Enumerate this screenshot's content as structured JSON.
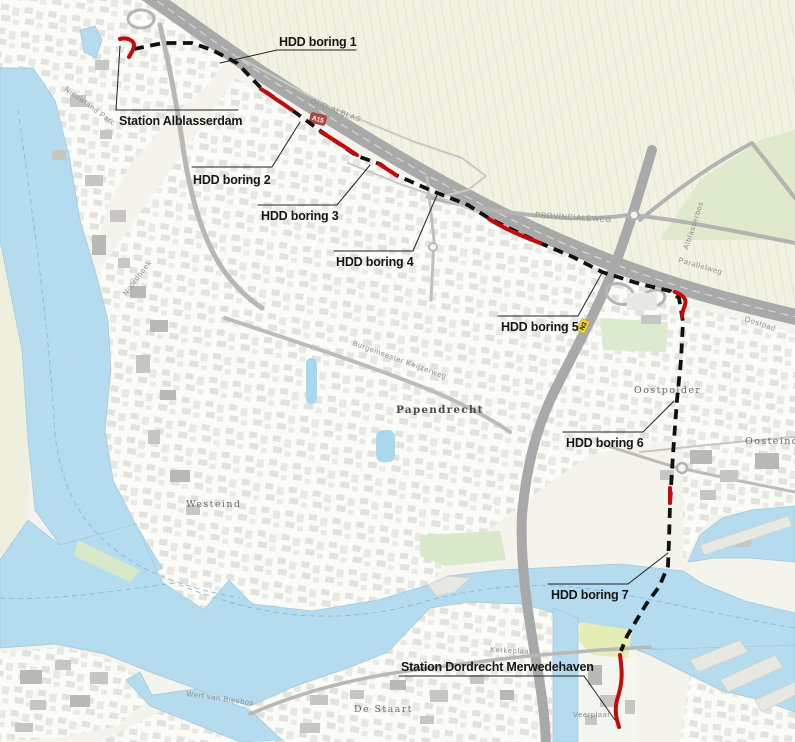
{
  "callouts": [
    {
      "id": "hdd-boring-1",
      "label": "HDD boring 1"
    },
    {
      "id": "hdd-boring-2",
      "label": "HDD boring 2"
    },
    {
      "id": "hdd-boring-3",
      "label": "HDD boring 3"
    },
    {
      "id": "hdd-boring-4",
      "label": "HDD boring 4"
    },
    {
      "id": "hdd-boring-5",
      "label": "HDD boring 5"
    },
    {
      "id": "hdd-boring-6",
      "label": "HDD boring 6"
    },
    {
      "id": "hdd-boring-7",
      "label": "HDD boring 7"
    },
    {
      "id": "station-alblasserdam",
      "label": "Station Alblasserdam"
    },
    {
      "id": "station-dordrecht-merwedehaven",
      "label": "Station Dordrecht Merwedehaven"
    }
  ],
  "places": [
    {
      "text": "Papendrecht"
    },
    {
      "text": "Westeind"
    },
    {
      "text": "Oosteind"
    },
    {
      "text": "Oostpolder"
    },
    {
      "text": "De Staart"
    },
    {
      "text": "Alblasserbos"
    }
  ],
  "roads": [
    {
      "text": "OUD-ALBLAS"
    },
    {
      "text": "PROVINCIALEWEG"
    },
    {
      "text": "Parallelweg"
    },
    {
      "text": "Oostpad"
    },
    {
      "text": "Noordhoek"
    },
    {
      "text": "Nieuwland Parc"
    },
    {
      "text": "Burgemeester Keijzerweg"
    },
    {
      "text": "Werf van Biesbos"
    },
    {
      "text": "Kerkeplaat"
    },
    {
      "text": "Veerplaat"
    }
  ],
  "shields": [
    {
      "text": "A15"
    },
    {
      "text": "N3"
    }
  ],
  "colors": {
    "route_dashed": "#111111",
    "hdd_boring_red": "#c40a0a",
    "water": "#b5dbee",
    "motorway": "#a9a9a9",
    "polder_fields": "#f1f2e1"
  }
}
